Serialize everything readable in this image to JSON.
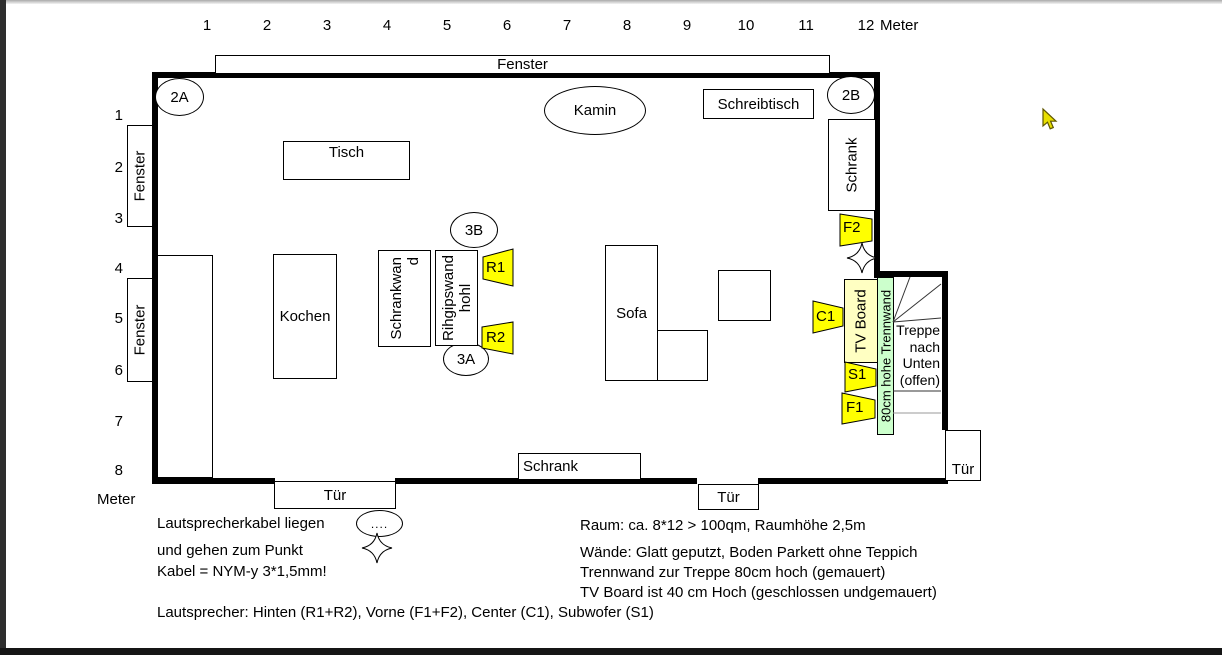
{
  "rulers": {
    "top_labels": [
      "1",
      "2",
      "3",
      "4",
      "5",
      "6",
      "7",
      "8",
      "9",
      "10",
      "11",
      "12"
    ],
    "top_unit": "Meter",
    "left_labels": [
      "1",
      "2",
      "3",
      "4",
      "5",
      "6",
      "7",
      "8"
    ],
    "left_unit": "Meter"
  },
  "plan": {
    "window_top": "Fenster",
    "window_left_upper": "Fenster",
    "window_left_lower": "Fenster",
    "marker_top_left": "2A",
    "marker_top_right": "2B",
    "marker_wall_top": "3B",
    "marker_wall_bottom": "3A",
    "fireplace": "Kamin",
    "desk": "Schreibtisch",
    "table": "Tisch",
    "kitchen": "Kochen",
    "sofa": "Sofa",
    "cabinet_right": "Schrank",
    "cabinet_bottom": "Schrank",
    "cabinet_wall": "Schrankwand",
    "drywall": "Rihgipswand hohl",
    "tv_board": "TV Board",
    "partition": "80cm hohe Trennwand",
    "stairs": "Treppe nach Unten (offen)",
    "door_bottom_left": "Tür",
    "door_bottom_right": "Tür",
    "door_right": "Tür",
    "cable_dots": "...."
  },
  "speakers": {
    "r1": "R1",
    "r2": "R2",
    "f1": "F1",
    "f2": "F2",
    "c1": "C1",
    "s1": "S1"
  },
  "notes": {
    "cable1": "Lautsprecherkabel liegen",
    "cable2": "und gehen zum Punkt",
    "cable3": "Kabel = NYM-y 3*1,5mm!",
    "room1": "Raum: ca. 8*12 > 100qm, Raumhöhe 2,5m",
    "room2": "Wände: Glatt geputzt, Boden Parkett ohne Teppich",
    "room3": "Trennwand zur Treppe 80cm hoch (gemauert)",
    "room4": "TV Board ist  40 cm Hoch (geschlossen undgemauert)",
    "speakers_legend": "Lautsprecher: Hinten (R1+R2), Vorne (F1+F2), Center (C1), Subwofer (S1)"
  },
  "colors": {
    "speaker_fill": "#ffff00",
    "tv_board_fill": "#ffffc2",
    "partition_fill": "#ccffcc",
    "wall": "#000000",
    "cursor_fill": "#e8df00"
  }
}
